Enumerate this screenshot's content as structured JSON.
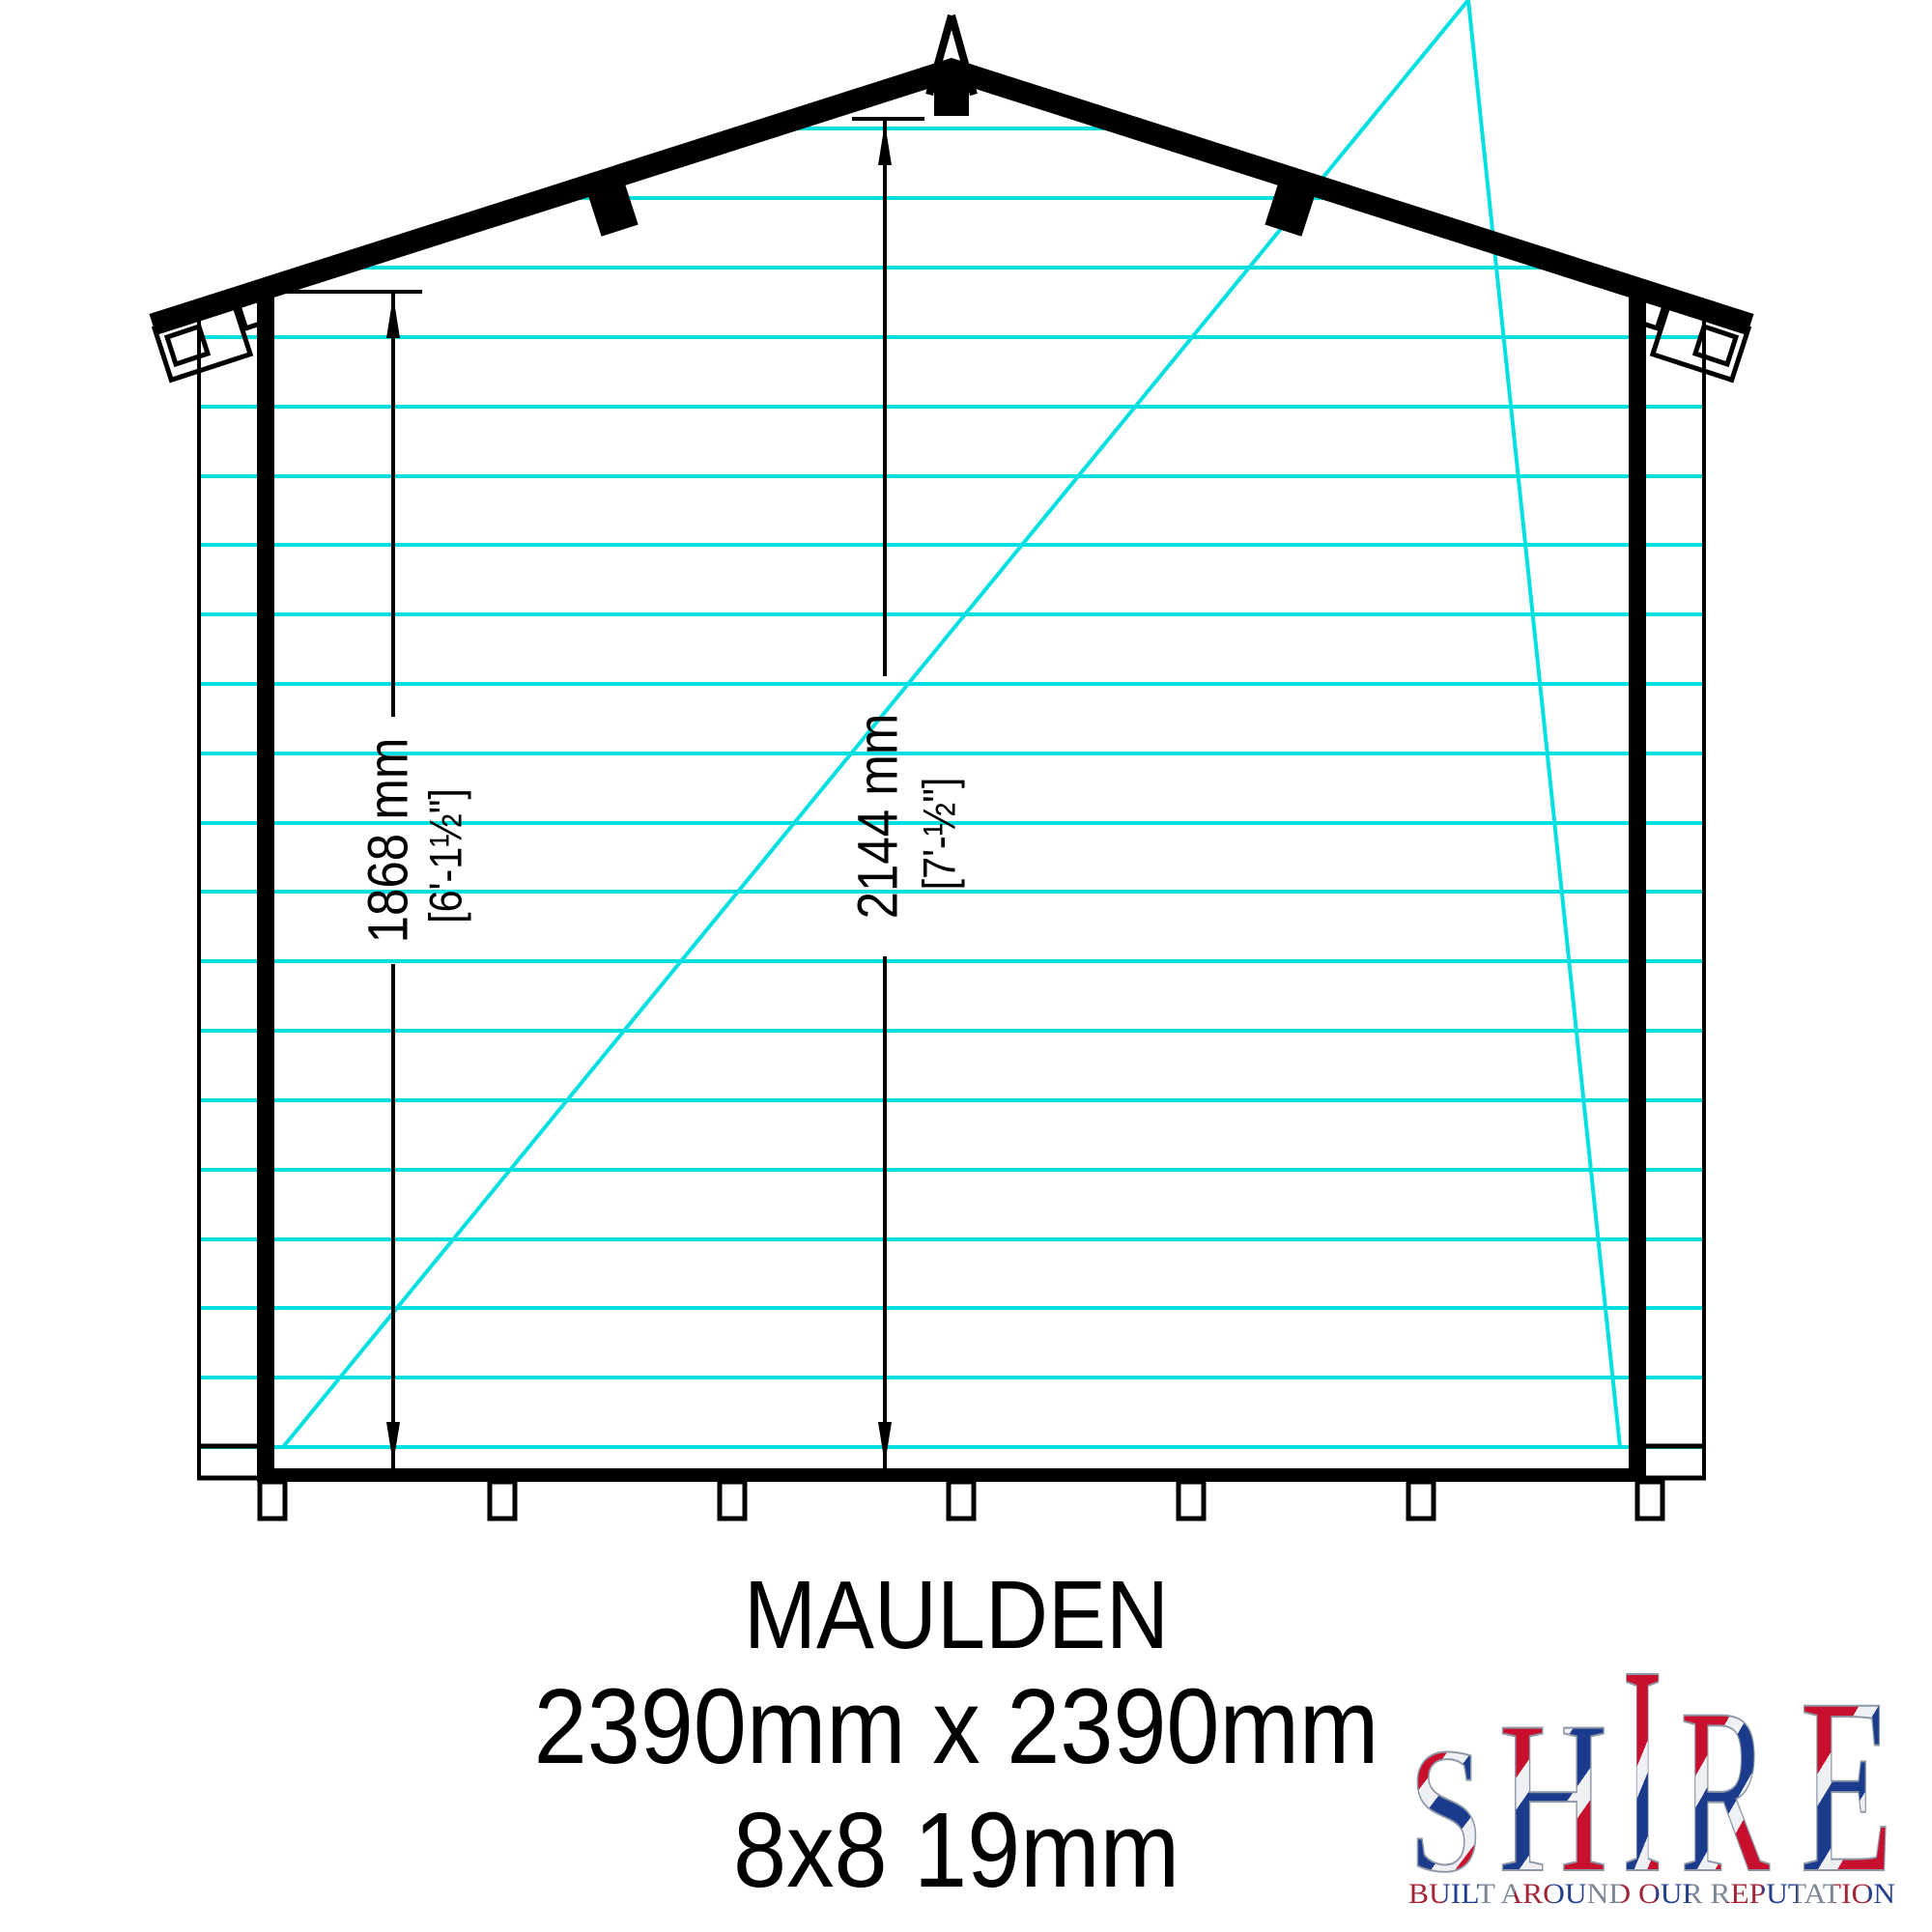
{
  "drawing": {
    "product_name": "MAULDEN",
    "dimensions_label": "2390mm x 2390mm",
    "spec_label": "8x8 19mm",
    "eaves_height_mm": "1868 mm",
    "eaves_height_imperial": "[6'-1½\"]",
    "ridge_height_mm": "2144 mm",
    "ridge_height_imperial": "[7'-½\"]"
  },
  "logo": {
    "letters": [
      "S",
      "H",
      "I",
      "R",
      "E"
    ],
    "tagline": "BUILT AROUND OUR REPUTATION"
  },
  "colors": {
    "cladding_line": "#00e0e0",
    "ink": "#000000",
    "logo_red": "#c8102e",
    "logo_blue": "#1b3c8c",
    "logo_silver": "#8d97a5"
  }
}
